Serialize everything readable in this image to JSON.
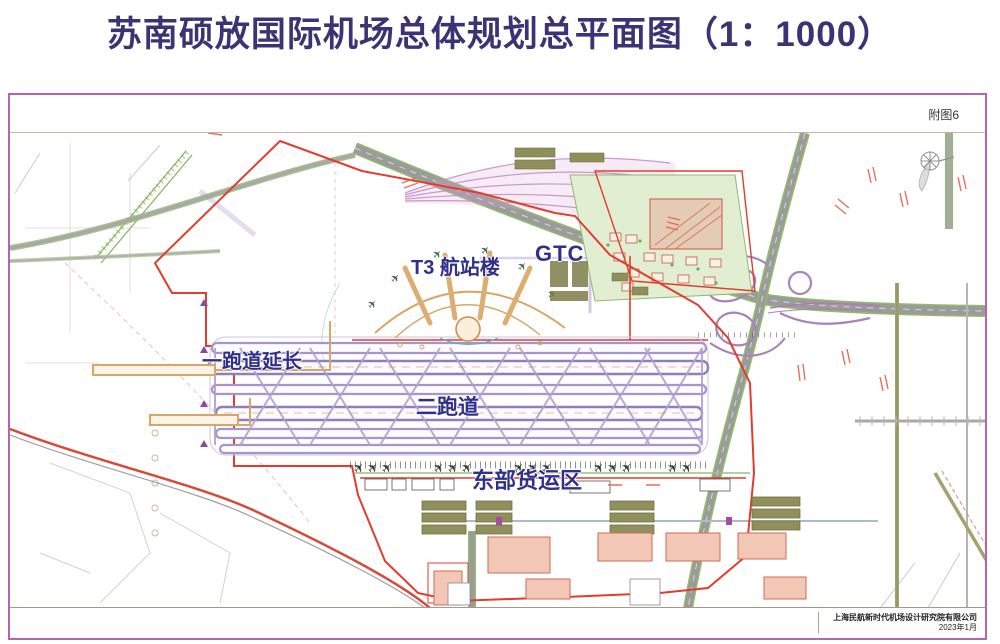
{
  "page": {
    "title": "苏南硕放国际机场总体规划总平面图（1：1000）"
  },
  "sheet": {
    "figure_number": "附图6",
    "annotations": {
      "t3_terminal": "T3 航站楼",
      "gtc": "GTC",
      "runway_extension": "一跑道延长",
      "second_runway": "二跑道",
      "east_cargo": "东部货运区"
    },
    "title_block": {
      "company": "上海民航新时代机场设计研究院有限公司",
      "date": "2023年1月"
    }
  },
  "icons": {
    "plane": "✈"
  },
  "colors": {
    "title_text": "#3c3375",
    "label_text": "#30308a",
    "frame_purple": "#b564ae",
    "boundary_red": "#e23c2e",
    "road_gray": "#9b9b9b",
    "road_green_edge": "#8fbc66",
    "taxiway_lavender": "#a895c8",
    "terminal_tan": "#d8a766",
    "cargo_olive": "#90905c",
    "building_salmon": "#f3c7b6",
    "zone_green": "#e2eed2"
  }
}
